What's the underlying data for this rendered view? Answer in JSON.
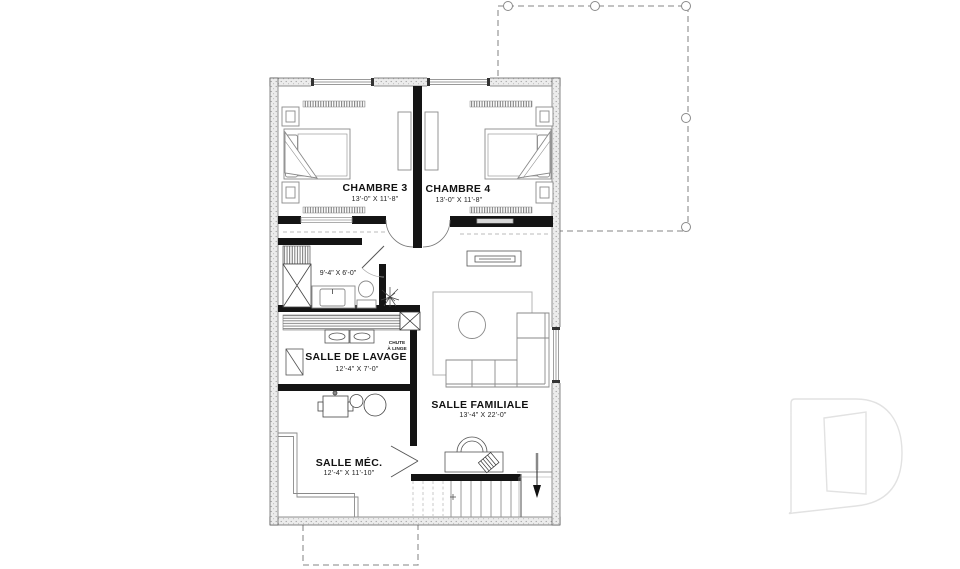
{
  "plan": {
    "type": "floor-plan",
    "language": "fr",
    "rooms": {
      "chambre3": {
        "name": "CHAMBRE 3",
        "dims": "13'-0\" X 11'-8\""
      },
      "chambre4": {
        "name": "CHAMBRE 4",
        "dims": "13'-0\" X 11'-8\""
      },
      "bathroom": {
        "dims": "9'-4\" X 6'-0\""
      },
      "laundry": {
        "name": "SALLE DE LAVAGE",
        "dims": "12'-4\" X 7'-0\""
      },
      "mechanical": {
        "name": "SALLE MÉC.",
        "dims": "12'-4\" X 11'-10\""
      },
      "family": {
        "name": "SALLE FAMILIALE",
        "dims": "13'-4\" X 22'-0\""
      }
    },
    "labels": {
      "chute_line1": "CHUTE",
      "chute_line2": "À LINGE"
    },
    "colors": {
      "background": "#ffffff",
      "interior_wall": "#141414",
      "exterior_wall_fill": "#e9e9e9",
      "exterior_wall_dot": "#9a9a9a",
      "furniture_line": "#8a8a8a",
      "fixture_line": "#555555",
      "dashed_outline": "#9e9e9e",
      "stair_tread": "#999999",
      "logo_line": "#e2e2e2"
    }
  }
}
